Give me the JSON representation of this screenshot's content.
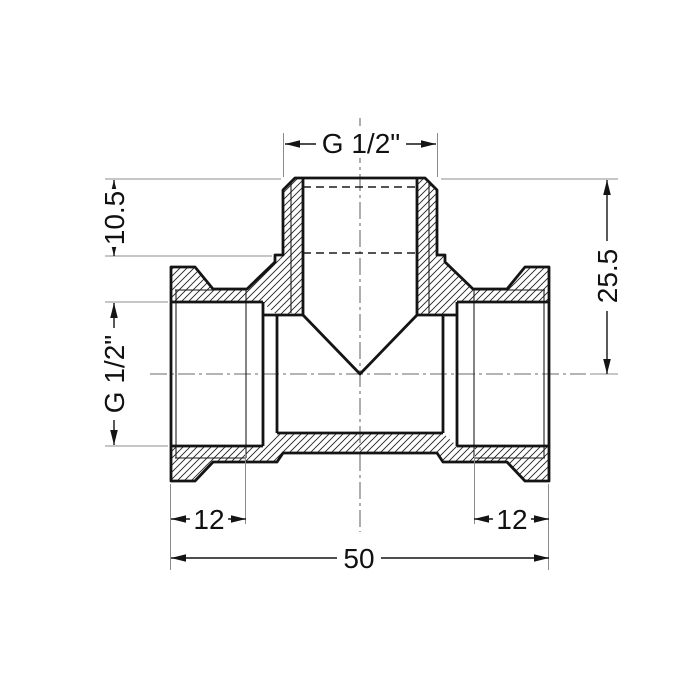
{
  "drawing": {
    "type": "technical-drawing",
    "subject": "pipe tee fitting cross-section",
    "dims": {
      "top_thread": "G 1/2\"",
      "branch_thread_depth": "10.5",
      "branch_to_center_height": "25.5",
      "side_thread": "G 1/2\"",
      "left_thread_depth": "12",
      "right_thread_depth": "12",
      "overall_length": "50"
    },
    "colors": {
      "outline": "#141414",
      "dimension_line": "#141414",
      "extension_line": "#8c8c8c",
      "centerline": "#6a6a6a",
      "background": "#ffffff"
    }
  }
}
